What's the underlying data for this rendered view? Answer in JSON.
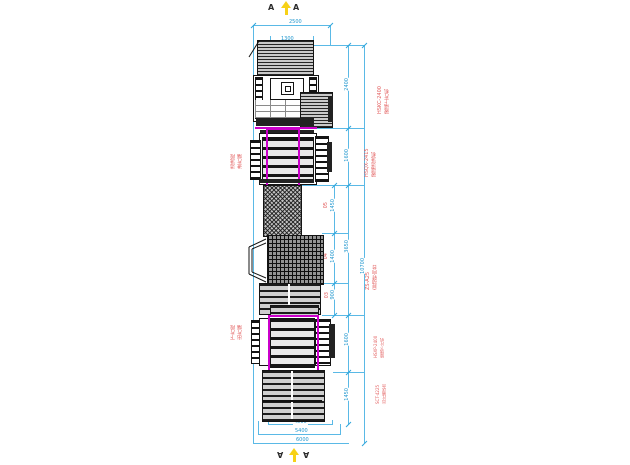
{
  "markers": {
    "top_left": "A",
    "top_right": "A",
    "bottom_left": "A",
    "bottom_right": "A"
  },
  "labels": {
    "right": [
      {
        "line1": "HSKC-2400",
        "line2": "玻璃上片机"
      },
      {
        "line1": "HSQX-2415",
        "line2": "玻璃清洗机"
      },
      {
        "line1": "ZS-A25",
        "line2": "自动转向台"
      },
      {
        "line1": "HSXP-2400",
        "line2": "玻璃下片机"
      },
      {
        "line1": "SCT-4225",
        "line2": "出片输送台"
      }
    ],
    "left": [
      {
        "line1": "清洗段",
        "line2": "进片端"
      },
      {
        "line1": "下片段",
        "line2": "出片端"
      }
    ],
    "segments": [
      "05",
      "04",
      "03"
    ]
  },
  "dims": {
    "top": [
      "2500",
      "1300"
    ],
    "bottom": [
      "4500",
      "5400",
      "6000"
    ],
    "chain": [
      "1450",
      "1400",
      "900"
    ],
    "machines": [
      "2400",
      "1600",
      "3650",
      "1600",
      "1450"
    ],
    "overall": "10700"
  },
  "colors": {
    "dimension_cyan": "#5ab9e6",
    "highlight_magenta": "#cb00cb",
    "label_red": "#e25b5b",
    "arrow_yellow": "#f7d117",
    "machine_ink": "#141414"
  }
}
